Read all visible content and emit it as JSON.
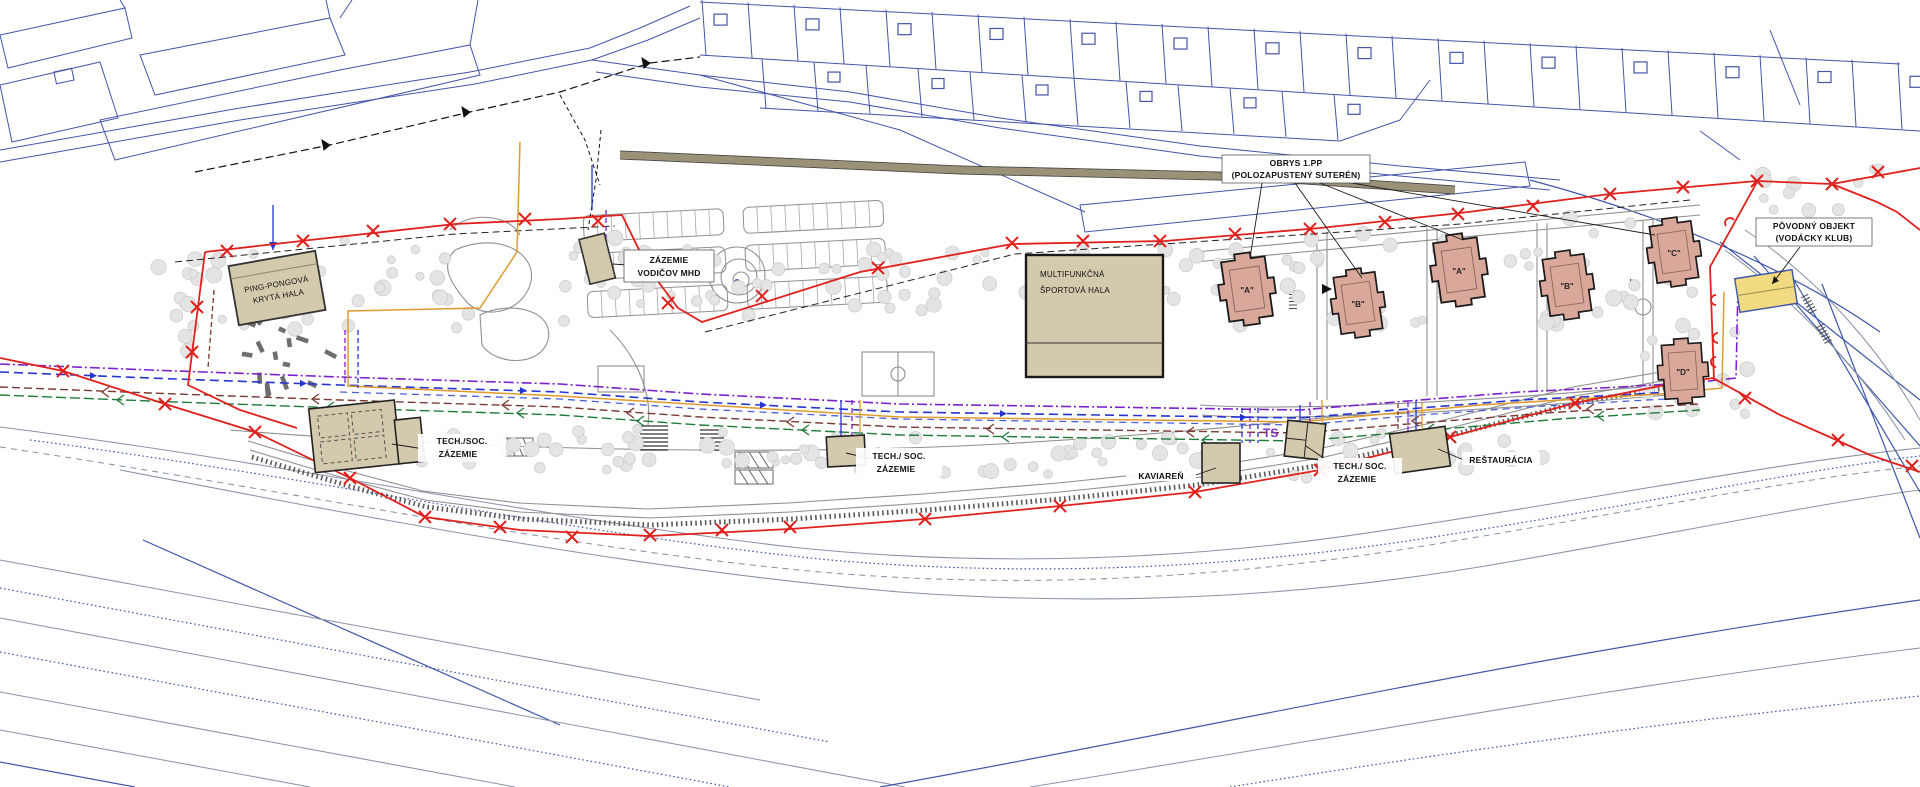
{
  "drawing": {
    "labels": {
      "ping_pong": [
        "PING-PONGOVÁ",
        "KRYTÁ HALA"
      ],
      "mhd": [
        "ZÁZEMIE",
        "VODIČOV MHD"
      ],
      "obrys": [
        "OBRYS 1.PP",
        "(POLOZAPUSTENÝ SUTERÉN)"
      ],
      "sports_hall": [
        "MULTIFUNKČNÁ",
        "ŠPORTOVÁ HALA"
      ],
      "povodny": [
        "PÔVODNÝ OBJEKT",
        "(VODÁCKY KLUB)"
      ],
      "tech_soc_1": [
        "TECH./SOC.",
        "ZÁZEMIE"
      ],
      "tech_soc_2": [
        "TECH./ SOC.",
        "ZÁZEMIE"
      ],
      "tech_soc_3": [
        "TECH./ SOC.",
        "ZÁZEMIE"
      ],
      "cafe": "KAVIAREŇ",
      "restaurant": "REŠTAURÁCIA",
      "transformer": "TS",
      "buildings": [
        "\"A\"",
        "\"B\"",
        "\"A\"",
        "\"B\"",
        "\"C\"",
        "\"D\""
      ]
    },
    "colors": {
      "cadastral_blue": "#4355a8",
      "boundary_red": "#e0201c",
      "building_tan": "#d3c9ac",
      "building_salmon": "#d9a89b",
      "building_yellow": "#f1da7f",
      "utility_purple": "#7b22cc",
      "utility_blue": "#2635cf",
      "utility_orange": "#e09a2f",
      "utility_green": "#1e7b38",
      "utility_brown": "#7a3a32",
      "road_gray": "#8f8f8f",
      "tree_gray": "#e4e4e4",
      "road_band_khaki": "#9a9176"
    }
  }
}
